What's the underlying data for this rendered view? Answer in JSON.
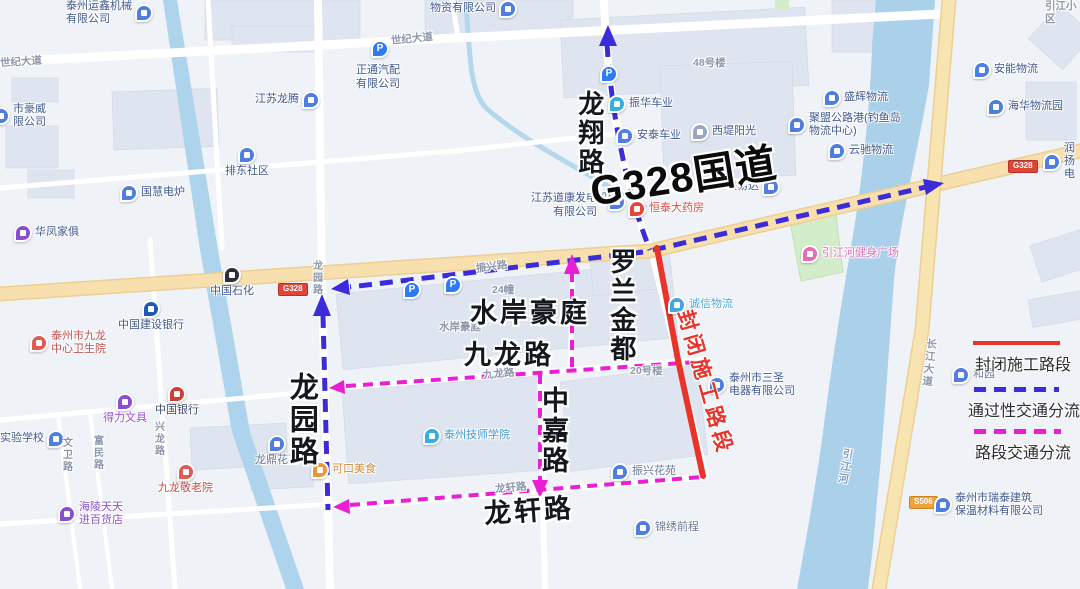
{
  "annotations": {
    "g328": "G328国道",
    "longxiang": "龙翔路",
    "luolan": "罗兰金都",
    "shuian": "水岸豪庭",
    "jiulong": "九龙路",
    "zhongjia": "中嘉路",
    "longxuan": "龙轩路",
    "longyuan": "龙园路",
    "closed": "封闭施工路段"
  },
  "legend": {
    "closed": "封闭施工路段",
    "through": "通过性交通分流",
    "section": "路段交通分流"
  },
  "badges": {
    "g328": "G328",
    "s506": "S506"
  },
  "icons": {
    "parking": "P",
    "school": "文"
  },
  "colors": {
    "closed": "#e8342a",
    "through": "#3b2bd8",
    "section": "#ea1fd4"
  },
  "labels": {
    "yunxin": "泰州运鑫机械\n有限公司",
    "wuzi": "物资有限公司",
    "shiji_top": "世纪大道",
    "shiji_left": "世纪大道",
    "jslt": "江苏龙腾",
    "zhengtong": "正通汽配\n有限公司",
    "haowei": "市豪威\n限公司",
    "guohui": "国慧电炉",
    "paidong": "排东社区",
    "huafeng": "华凤家俱",
    "zhenhua": "振华车业",
    "antai": "安泰车业",
    "xidi": "西堤阳光",
    "shenghui": "盛辉物流",
    "jumeng": "聚盟公路港(钓鱼岛\n物流中心)",
    "yunchi": "云驰物流",
    "anneng": "安能物流",
    "haihua": "海华物流园",
    "runyang": "润扬电",
    "yinjiangxq": "引江小区",
    "lou48": "48号楼",
    "daokang": "江苏道康发电机组\n有限公司",
    "hengtai": "恒泰大药房",
    "kuaiyida": "快易达",
    "zhenxinglu": "振兴路",
    "longyuan_sm": "龙园路",
    "sinopec": "中国石化",
    "ccb": "中国建设银行",
    "hospital": "泰州市九龙\n中心卫生院",
    "shuian_sm": "水岸豪庭",
    "jiulong_sm": "九龙路",
    "f24": "24幢",
    "f20": "20号楼",
    "chengxin": "诚信物流",
    "sansheng": "泰州市三圣\n电器有限公司",
    "gym": "引江河健身广场",
    "heyuan": "和园",
    "changjiang": "长江大道",
    "yinjianghe": "引江河",
    "ruitai": "泰州市瑞泰建筑\n保温材料有限公司",
    "deli": "得力文具",
    "boc": "中国银行",
    "school": "实验学校",
    "wenwei": "文卫路",
    "fumin": "富民路",
    "xinglong": "兴龙路",
    "jingly": "九龙敬老院",
    "longding": "龙鼎花苑",
    "hailing": "海陵天天\n进百货店",
    "kekou": "可口美食",
    "college": "泰州技师学院",
    "longxuan_sm": "龙轩路",
    "zhenxinghy": "振兴花苑",
    "jinxiu": "锦绣前程"
  }
}
